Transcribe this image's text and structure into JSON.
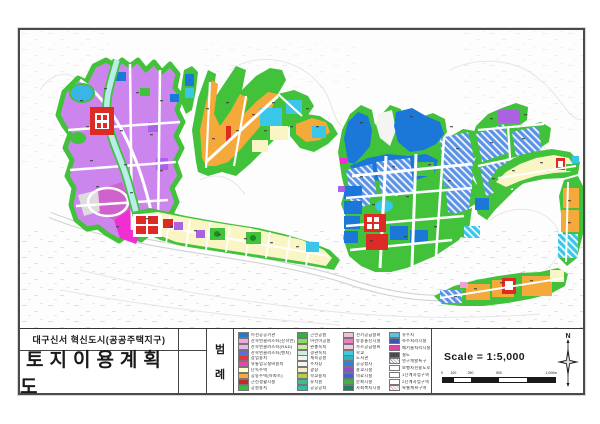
{
  "title_block": {
    "project": "대구신서 혁신도시(공공주택지구)",
    "title": "토지이용계획도"
  },
  "legend": {
    "label_chars": [
      "범",
      "례"
    ],
    "columns": [
      [
        {
          "c": "#1f7ad4",
          "t": "이전공공기관"
        },
        {
          "c": "#f2a8da",
          "t": "산학연클러스터(산학연)"
        },
        {
          "c": "#e3b8ec",
          "t": "산학연클러스터(R&D)"
        },
        {
          "c": "#5c6fdd",
          "t": "산학연클러스터(벤처)"
        },
        {
          "c": "#e23c2e",
          "t": "상업용지"
        },
        {
          "c": "#ef3fb0",
          "t": "유통업무설비용지"
        },
        {
          "c": "#ffffc9",
          "t": "단독주택"
        },
        {
          "c": "#f5ac3e",
          "t": "공동주택(아파트)"
        },
        {
          "c": "#c9262a",
          "t": "근린생활시설"
        },
        {
          "c": "#35bf3f",
          "t": "공원용지"
        }
      ],
      [
        {
          "c": "#2fb33a",
          "t": "근린공원"
        },
        {
          "c": "#8cd964",
          "t": "어린이공원"
        },
        {
          "c": "#c7eba0",
          "t": "완충녹지"
        },
        {
          "c": "#cdeedd",
          "t": "경관녹지"
        },
        {
          "c": "#eef4ee",
          "t": "체육공원"
        },
        {
          "c": "#f4f4f0",
          "t": "주차장"
        },
        {
          "c": "#f2eec9",
          "t": "광장"
        },
        {
          "c": "#b5cd4c",
          "t": "학교용지"
        },
        {
          "c": "#3fbb8f",
          "t": "유치원"
        },
        {
          "c": "#2fbfa4",
          "t": "공공공지"
        }
      ],
      [
        {
          "c": "#f3bcd8",
          "t": "전기공급설비"
        },
        {
          "c": "#ef7fc0",
          "t": "방송통신시설"
        },
        {
          "c": "#f6cade",
          "t": "가스공급설비"
        },
        {
          "c": "#41c9e4",
          "t": "학교"
        },
        {
          "c": "#2fb5b5",
          "t": "도서관"
        },
        {
          "c": "#3b79de",
          "t": "공공청사"
        },
        {
          "c": "#8f4fc9",
          "t": "종교시설"
        },
        {
          "c": "#3f62d6",
          "t": "의료시설"
        },
        {
          "c": "#3fb441",
          "t": "문화시설"
        },
        {
          "c": "#1f7f62",
          "t": "사회복지시설"
        }
      ],
      [
        {
          "c": "#57c4e6",
          "t": "유수지"
        },
        {
          "c": "#3b57b5",
          "t": "하수처리시설"
        },
        {
          "c": "#e83ca9",
          "t": "폐기물처리시설"
        },
        {
          "c": "#4a4a4a",
          "t": "철도"
        },
        {
          "c": "#c9ccd4",
          "t": "연구개발특구",
          "h": "hatch-gray"
        },
        {
          "c": "#ffffff",
          "t": "보행자전용도로"
        },
        {
          "c": "#ffffff",
          "t": "1단계사업구역"
        },
        {
          "c": "#ffffff",
          "t": "2단계사업구역"
        },
        {
          "c": "#fbdce8",
          "t": "특별계획구역",
          "h": "hatch-pink"
        }
      ]
    ]
  },
  "scale": {
    "text": "Scale = 1:5,000",
    "ticks": [
      "0",
      "100",
      "250",
      "500",
      "1,000m"
    ]
  },
  "north": {
    "label": "N"
  },
  "palette": {
    "violet": "#cd85ee",
    "orchid_dark": "#cf62cc",
    "magenta": "#f02ed2",
    "green": "#41c23a",
    "green_dark": "#178f1e",
    "blue": "#1b78d8",
    "blue_hatch": "#5a93e6",
    "skyblue": "#3ab5ea",
    "cyan": "#39c6e9",
    "cyan_pale": "#b9ecec",
    "orange": "#f4a93a",
    "yellow_pale": "#f9f5c5",
    "red": "#dd2a24",
    "purple": "#ab62e2",
    "pink": "#efa0d4",
    "gray_parcel": "#dcdcdc",
    "hill": "#f4f4f1",
    "contour": "#e6e6e6",
    "road": "#ffffff",
    "road_casing": "#d2d2d2"
  }
}
